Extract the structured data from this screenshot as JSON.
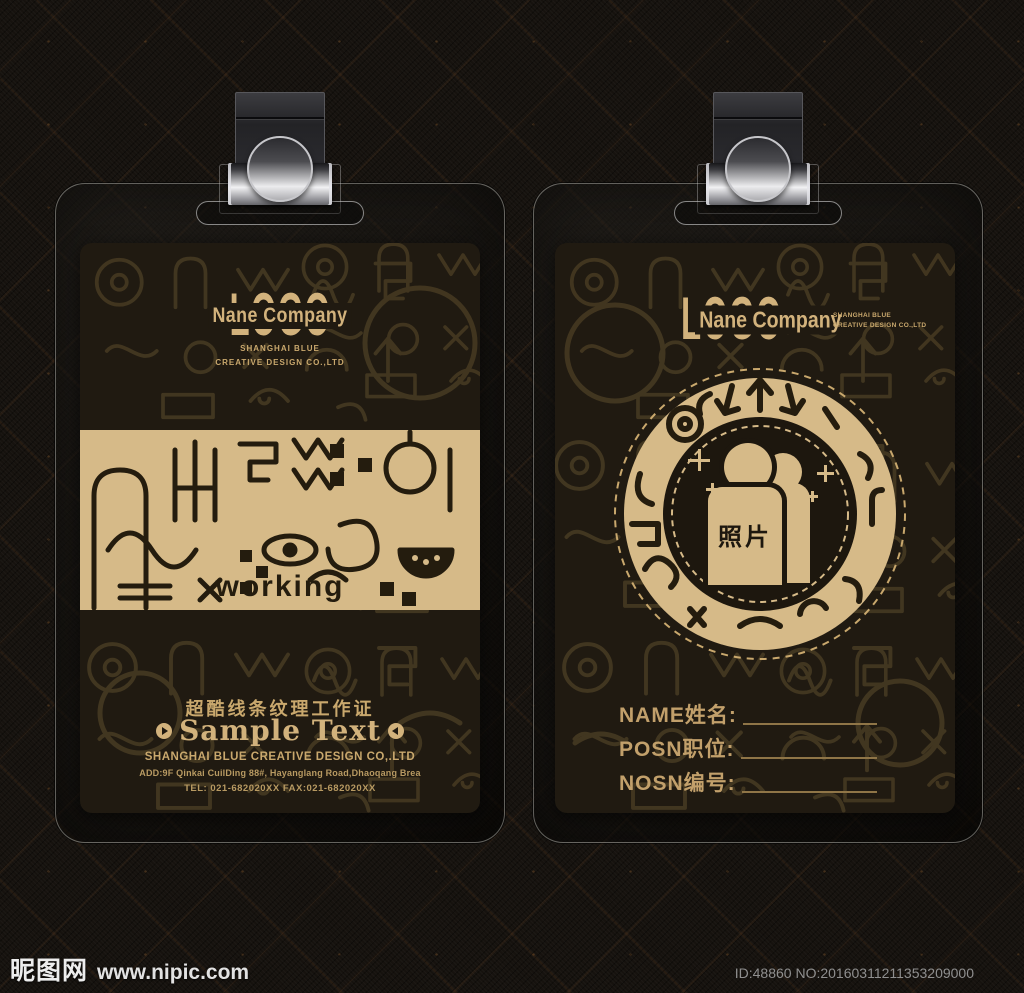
{
  "watermark": {
    "site_name": "昵图网",
    "site_url": "www.nipic.com",
    "id_text": "ID:48860 NO:20160311211353209000"
  },
  "colors": {
    "gold": "#d2b27c",
    "gold_deep": "#c9a86d",
    "band_gold": "#d6ba88",
    "card_bg": "#201a11",
    "dark_ink": "#241c0e"
  },
  "front_card": {
    "logo": {
      "logo_text": "LOGO",
      "company_name": "Nane Company",
      "tagline_line1": "SHANGHAI BLUE",
      "tagline_line2": "CREATIVE DESIGN CO.,LTD"
    },
    "band_caption": "working",
    "title_cn": "超酷线条纹理工作证",
    "sample_text": "Sample Text",
    "company_line": "SHANGHAI BLUE CREATIVE DESIGN CO,.LTD",
    "address_line": "ADD:9F Qinkai CuilDing 88#, Hayanglang Road,Dhaoqang Brea",
    "tel_line": "TEL: 021-682020XX  FAX:021-682020XX"
  },
  "back_card": {
    "logo": {
      "logo_text": "LOGO",
      "company_name": "Nane Company",
      "tagline_line1": "SHANGHAI BLUE",
      "tagline_line2": "CREATIVE DESIGN CO.,LTD"
    },
    "photo_label": "照片",
    "fields": [
      {
        "label": "NAME姓名:"
      },
      {
        "label": "POSN职位:"
      },
      {
        "label": "NOSN编号:"
      }
    ]
  }
}
